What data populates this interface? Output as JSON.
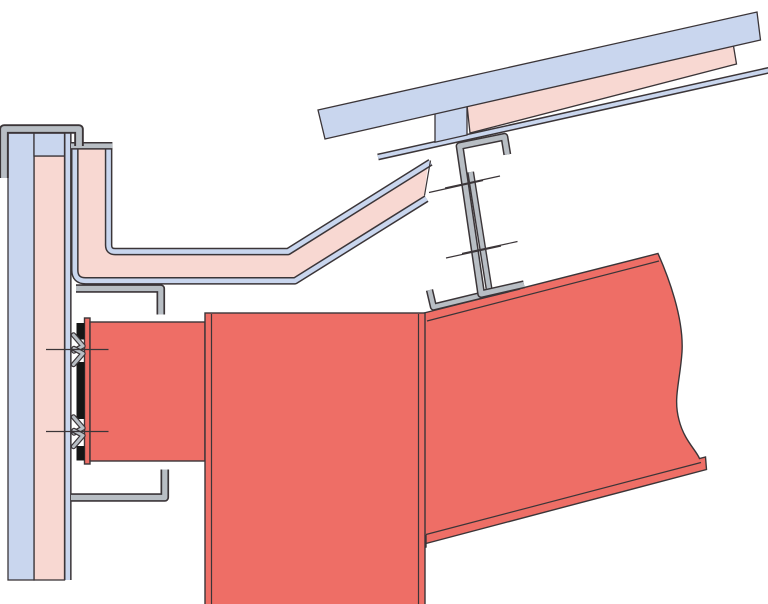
{
  "figure": {
    "type": "construction-detail-drawing",
    "description": "Sectional detail of an eaves junction: insulated wall panel, insulated soffit panel, sloped insulated roof panel, zed purlin on cleat, steel rafter and column with bolted end-plate connection",
    "text_labels": [],
    "colors": {
      "background": "#ffffff",
      "cladding_blue": "#c9d6ee",
      "insulation_pink": "#f8d8d2",
      "steel_red": "#ee6e66",
      "steel_gray": "#b8bec4",
      "outline_dark": "#3b3538",
      "gasket_black": "#161616"
    },
    "components": [
      "wall-cap-flashing",
      "wall-outer-sheet",
      "wall-insulation",
      "wall-liner-sheet",
      "soffit-panel",
      "soffit-support-angle",
      "bottom-support-bracket",
      "roof-outer-panel",
      "roof-insulation",
      "roof-liner-sheet",
      "roof-spacer-block",
      "zed-purlin",
      "purlin-cleat-plate",
      "purlin-seat-angle",
      "purlin-bolt-marks",
      "steel-rafter",
      "steel-column",
      "beam-stub",
      "end-plate",
      "end-plate-gasket",
      "connection-bolt-lines",
      "connection-bolt-chevrons"
    ],
    "bolt_groups": {
      "wall_connection_bolts": 2,
      "purlin_web_bolts": 2
    },
    "roof_slope_degrees": 12.5
  }
}
